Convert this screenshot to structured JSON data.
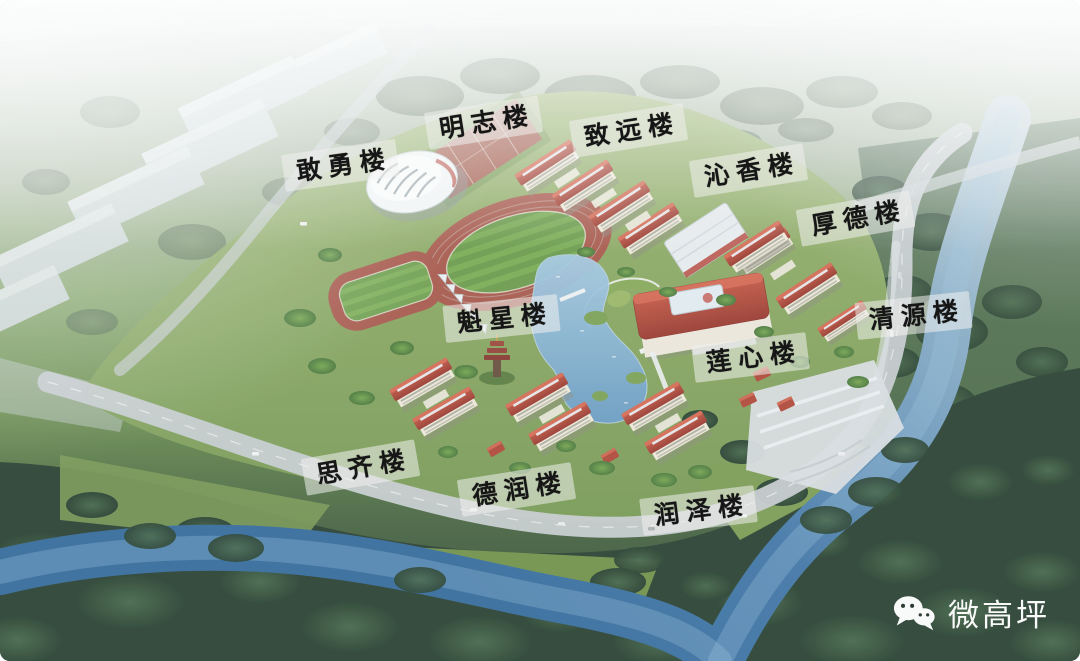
{
  "image_type": "aerial rendering of a school campus with labeled buildings",
  "labels": [
    {
      "id": "ganyong",
      "text": "敢勇楼"
    },
    {
      "id": "mingzhi",
      "text": "明志楼"
    },
    {
      "id": "zhiyuan",
      "text": "致远楼"
    },
    {
      "id": "qinxiang",
      "text": "沁香楼"
    },
    {
      "id": "houde",
      "text": "厚德楼"
    },
    {
      "id": "qingyuan",
      "text": "清源楼"
    },
    {
      "id": "kuixing",
      "text": "魁星楼"
    },
    {
      "id": "lianxin",
      "text": "莲心楼"
    },
    {
      "id": "siqi",
      "text": "思齐楼"
    },
    {
      "id": "derun",
      "text": "德润楼"
    },
    {
      "id": "runze",
      "text": "润泽楼"
    }
  ],
  "watermark": {
    "text": "微高坪",
    "icon": "wechat-icon"
  },
  "colors": {
    "label_background": "rgba(240,241,238,0.55)",
    "label_text": "#161616",
    "roof_red": "#b0493d",
    "track_red": "#aa5d51",
    "field_green": "#6f9e50",
    "campus_lawn": "#86a764",
    "river_blue": "#3e74a6",
    "forest_green": "#2f4538",
    "road_gray": "#c8cdd1",
    "haze_white": "#ffffff",
    "watermark_text": "#ffffff"
  }
}
